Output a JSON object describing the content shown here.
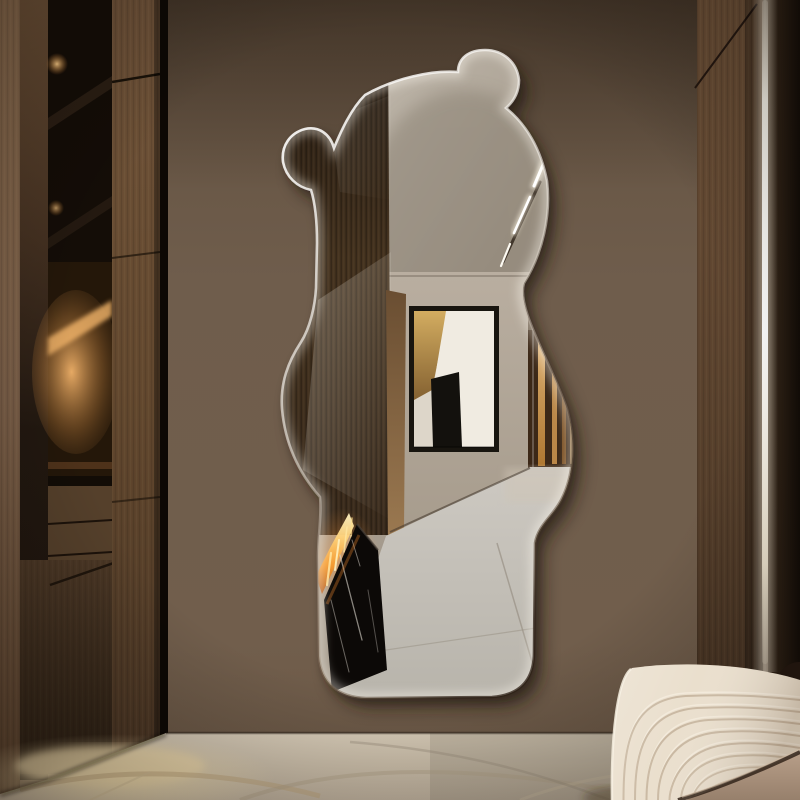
{
  "scene": {
    "title": "Bear-shaped frameless wall mirror hung on a taupe wall in a modern hallway, beside a dark wood wardrobe with lit niche, over a marble floor, next to a cream channel-tufted bench and an LED-lit wood wall panel",
    "objects": [
      "taupe painted wall",
      "dark wood wardrobe with illuminated niche and shelf spotlights",
      "bear-shaped frameless wall mirror with rim light and drop shadow",
      "mirror reflection: hallway with dark wood fireplace wall",
      "mirror reflection: abstract framed artwork (white, black, gold)",
      "mirror reflection: linear ethanol fireplace with flames and black marble hearth",
      "mirror reflection: glass display cabinet with amber lighting",
      "mirror reflection: diagonal recessed ceiling light",
      "mirror reflection: grey marble floor",
      "beige marble floor with under-cabinet warm glow",
      "wood wall panel with vertical LED light strip",
      "cream channel-tufted bench sofa with taupe seat cushion",
      "dark brown round cushion"
    ],
    "colors": {
      "wall": "#6e5c4b",
      "wall_shadow": "#4e3f32",
      "wardrobe_frame": "#7c6049",
      "wardrobe_door": "#5c4430",
      "wardrobe_interior": "#16100a",
      "niche_glow": "#e8a85e",
      "shelf_spot_light": "#ffcf8a",
      "right_panel_wood": "#644a33",
      "right_panel_dark": "#1c120b",
      "led_strip": "#fffdf4",
      "floor_marble": "#cfc1ab",
      "floor_glow": "#f6e2b2",
      "mirror_rim_highlight": "#ffffff",
      "mirror_shadow": "#1f140c",
      "reflection_ceiling": "#aaa092",
      "reflection_wall": "#b3a899",
      "reflection_wood_panel": "#33271b",
      "reflection_floor": "#c6c2bb",
      "artwork_frame": "#18150f",
      "artwork_canvas": "#eee9df",
      "artwork_black": "#13110d",
      "artwork_gold": "#c49a4e",
      "glass_cabinet_amber": "#e8b06a",
      "fireplace_black": "#0c0907",
      "flame_core": "#ffe9ad",
      "flame_orange": "#f79a2c",
      "sofa_fabric": "#eadfcd",
      "sofa_groove": "#c3b29a",
      "sofa_seat": "#a58d79",
      "sofa_pillow": "#20150e"
    }
  }
}
